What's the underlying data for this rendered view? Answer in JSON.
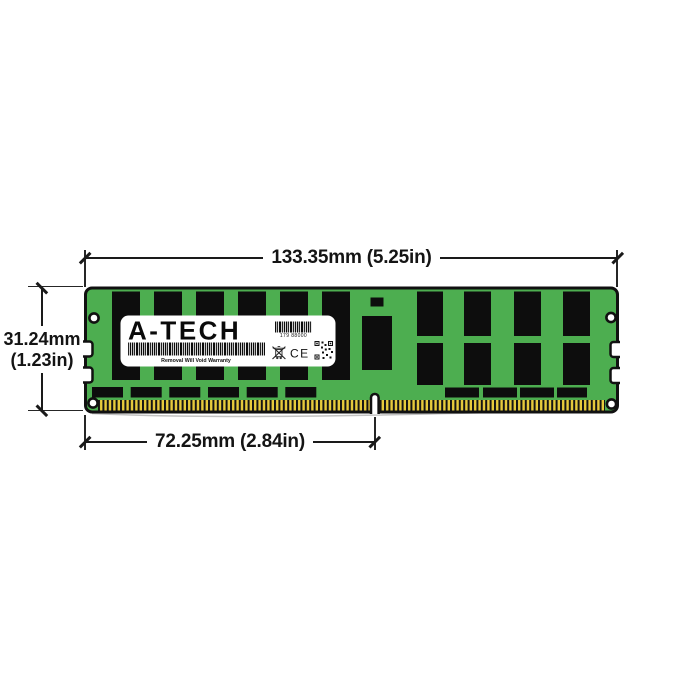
{
  "dimensions": {
    "width": "133.35mm (5.25in)",
    "height_mm": "31.24mm",
    "height_in": "(1.23in)",
    "pin_span": "72.25mm (2.84in)"
  },
  "module": {
    "brand": "A-TECH",
    "label": {
      "serial": "179 88000",
      "warranty": "Removal Will Void Warranty",
      "ce": "CE"
    },
    "colors": {
      "pcb_green": "#4DAE50",
      "chip_black": "#0D0D0D",
      "pin_gold": "#E7CB3C",
      "outline": "#111111",
      "label_bg": "#FFFFFF",
      "dimension_line": "#1A1A1A"
    }
  }
}
